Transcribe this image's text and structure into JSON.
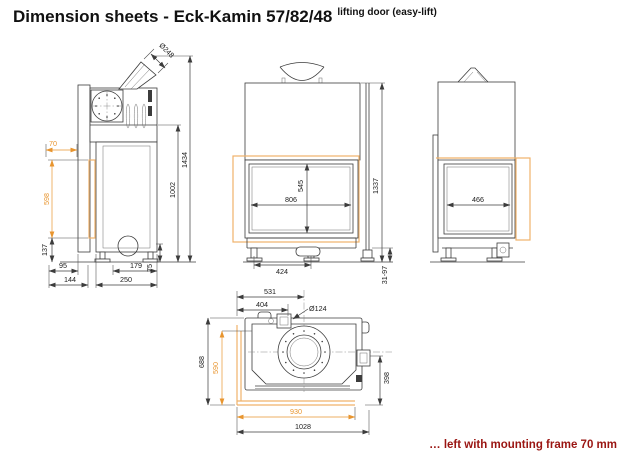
{
  "header": {
    "title": "Dimension sheets - Eck-Kamin 57/82/48",
    "variant": "lifting door (easy-lift)"
  },
  "footer": {
    "note": "… left with mounting frame 70 mm"
  },
  "colors": {
    "line": "#3c3c3c",
    "dim_text": "#1c1c1c",
    "frame_orange_line": "#f0b26a",
    "frame_orange_text": "#e8952f",
    "note_red": "#9a1512",
    "background": "#ffffff"
  },
  "views": {
    "side_left": {
      "dims": {
        "flue_diameter": "Ø248",
        "overall_height": "1434",
        "body_height": "1002",
        "mounting_frame_depth": "70",
        "mounting_frame_height": "598",
        "plinth_height": "137",
        "back_offset": "95",
        "back_depth": "144",
        "foot_offset": "179",
        "body_depth": "250",
        "foot_height": "75"
      }
    },
    "front": {
      "dims": {
        "glass_width": "806",
        "glass_height": "545",
        "overall_height": "1337",
        "foot_spacing": "424",
        "foot_adjust_range": "31-97"
      }
    },
    "side_right": {
      "dims": {
        "glass_width": "466"
      }
    },
    "plan": {
      "dims": {
        "flue_center_offset": "531",
        "air_inlet_offset": "404",
        "air_inlet_diameter": "Ø124",
        "overall_depth": "688",
        "mounting_frame_depth": "590",
        "corner_offset": "398",
        "mounting_frame_width": "930",
        "overall_width": "1028"
      }
    }
  }
}
